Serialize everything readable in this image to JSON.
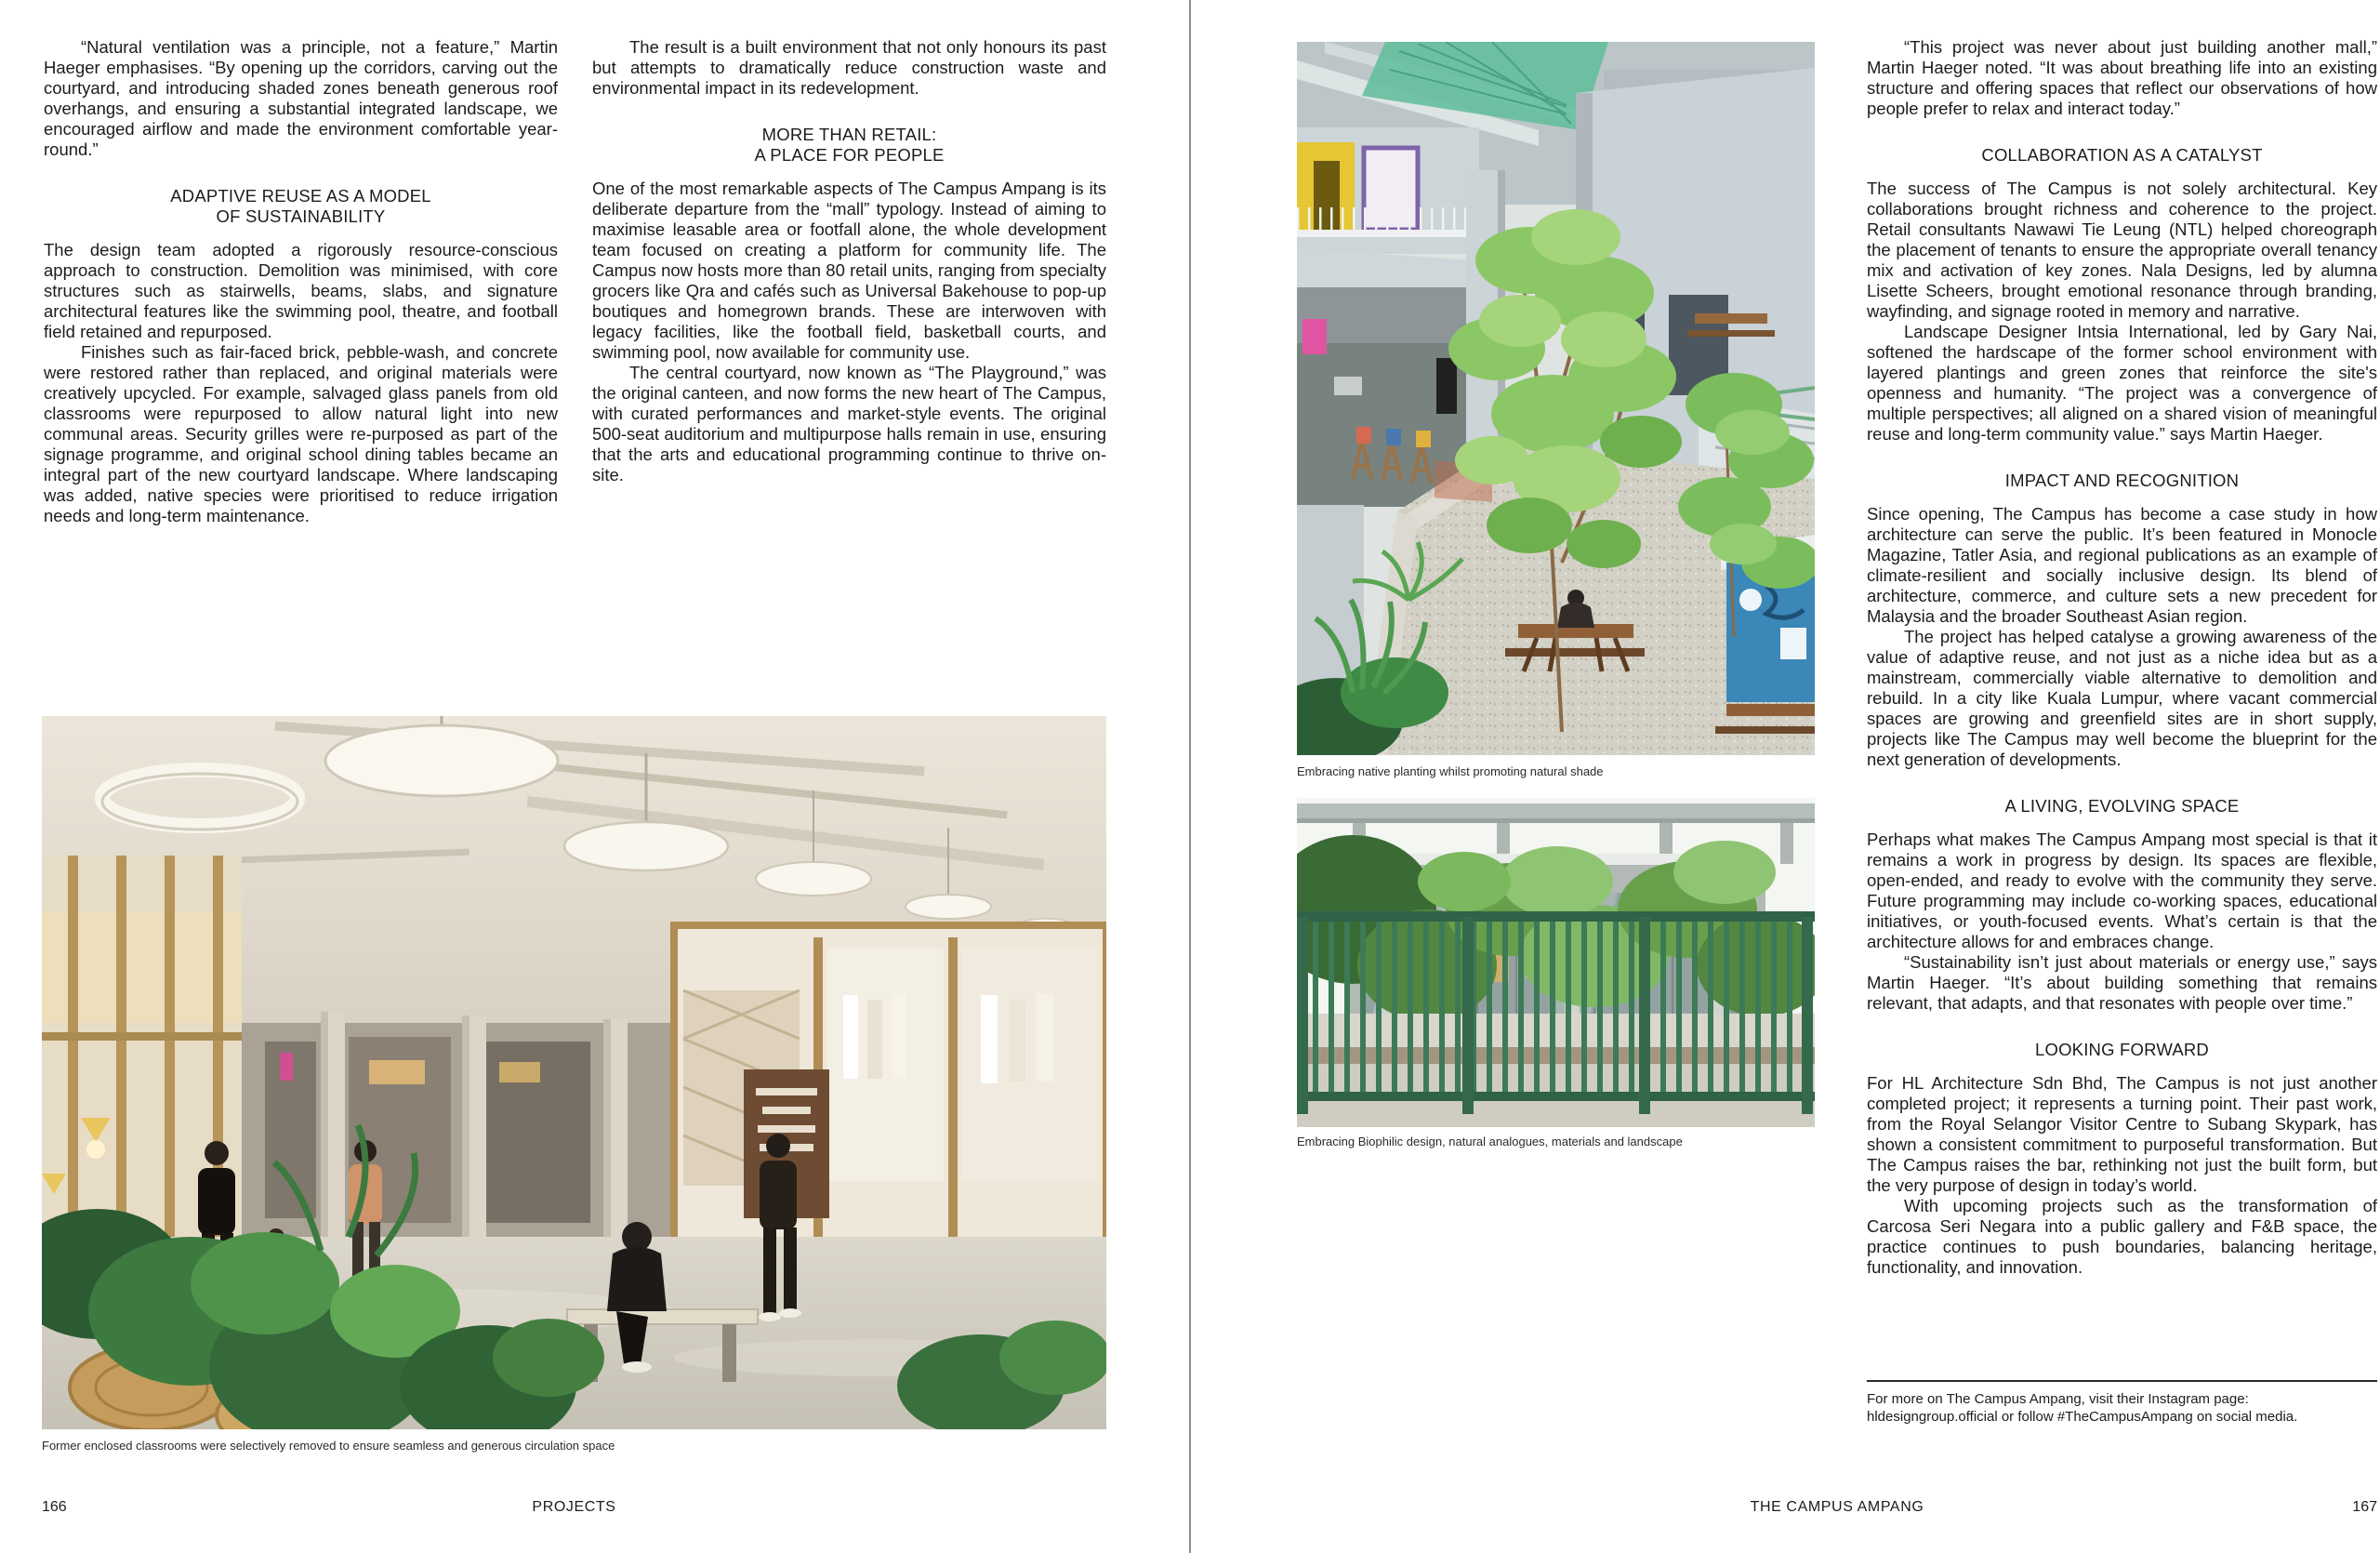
{
  "colors": {
    "paper": "#ffffff",
    "ink": "#1c1c1c",
    "caption": "#2a2a2a",
    "divider": "#8f8f8f",
    "note_rule": "#2a2a2a"
  },
  "page_left": {
    "page_number": "166",
    "running_foot": "PROJECTS",
    "col1": {
      "p1": "“Natural ventilation was a principle, not a feature,” Martin Haeger emphasises. “By opening up the corridors, carving out the courtyard, and introducing shaded zones beneath generous roof overhangs, and ensuring a substantial integrated landscape, we encouraged airflow and made the environment comfortable year-round.”",
      "heading": "ADAPTIVE REUSE AS A MODEL\nOF SUSTAINABILITY",
      "p2": "The design team adopted a rigorously resource-conscious approach to construction. Demolition was minimised, with core structures such as stairwells, beams, slabs, and signature architectural features like the swimming pool, theatre, and football field retained and repurposed.",
      "p3": "Finishes such as fair-faced brick, pebble-wash, and concrete were restored rather than replaced, and original materials were creatively upcycled. For example, salvaged glass panels from old classrooms were repurposed to allow natural light into new communal areas. Security grilles were re-purposed as part of the signage programme, and original school dining tables became an integral part of the new courtyard landscape. Where landscaping was added, native species were prioritised to reduce irrigation needs and long-term maintenance."
    },
    "col2": {
      "p1": "The result is a built environment that not only honours its past but attempts to dramatically reduce construction waste and environmental impact in its redevelopment.",
      "heading": "MORE THAN RETAIL:\nA PLACE FOR PEOPLE",
      "p2": "One of the most remarkable aspects of The Campus Ampang is its deliberate departure from the “mall” typology. Instead of aiming to maximise leasable area or footfall alone, the whole development team focused on creating a platform for community life. The Campus now hosts more than 80 retail units, ranging from specialty grocers like Qra and cafés such as Universal Bakehouse to pop-up boutiques and homegrown brands. These are interwoven with legacy facilities, like the football field, basketball courts, and swimming pool, now available for community use.",
      "p3": "The central courtyard, now known as “The Playground,” was the original canteen, and now forms the new heart of The Campus, with curated performances and market-style events. The original 500-seat auditorium and multipurpose halls remain in use, ensuring that the arts and educational programming continue to thrive on-site."
    },
    "photo_caption": "Former enclosed classrooms were selectively removed to ensure seamless and generous circulation space"
  },
  "page_right": {
    "page_number": "167",
    "running_foot": "THE CAMPUS AMPANG",
    "photo1_caption": "Embracing native planting whilst promoting natural shade",
    "photo2_caption": "Embracing Biophilic design, natural analogues, materials and landscape",
    "column": {
      "p1": "“This project was never about just building another mall,” Martin Haeger noted. “It was about breathing life into an existing structure and offering spaces that reflect our observations of how people prefer to relax and interact today.”",
      "h1": "COLLABORATION AS A CATALYST",
      "p2": "The success of The Campus is not solely architectural. Key collaborations brought richness and coherence to the project. Retail consultants Nawawi Tie Leung (NTL) helped choreograph the placement of tenants to ensure the appropriate overall tenancy mix and activation of key zones. Nala Designs, led by alumna Lisette Scheers, brought emotional resonance through branding, wayfinding, and signage rooted in memory and narrative.",
      "p3": "Landscape Designer Intsia International, led by Gary Nai, softened the hardscape of the former school environment with layered plantings and green zones that reinforce the site's openness and humanity. “The project was a convergence of multiple perspectives; all aligned on a shared vision of meaningful reuse and long-term community value.” says Martin Haeger.",
      "h2": "IMPACT AND RECOGNITION",
      "p4": "Since opening, The Campus has become a case study in how architecture can serve the public. It’s been featured in Monocle Magazine, Tatler Asia, and regional publications as an example of climate-resilient and socially inclusive design. Its blend of architecture, commerce, and culture sets a new precedent for Malaysia and the broader Southeast Asian region.",
      "p5": "The project has helped catalyse a growing awareness of the value of adaptive reuse, and not just as a niche idea but as a mainstream, commercially viable alternative to demolition and rebuild. In a city like Kuala Lumpur, where vacant commercial spaces are growing and greenfield sites are in short supply, projects like The Campus may well become the blueprint for the next generation of developments.",
      "h3": "A LIVING, EVOLVING SPACE",
      "p6": "Perhaps what makes The Campus Ampang most special is that it remains a work in progress by design. Its spaces are flexible, open-ended, and ready to evolve with the community they serve. Future programming may include co-working spaces, educational initiatives, or youth-focused events. What’s certain is that the architecture allows for and embraces change.",
      "p7": "“Sustainability isn’t just about materials or energy use,” says Martin Haeger. “It’s about building something that remains relevant, that adapts, and that resonates with people over time.”",
      "h4": "LOOKING FORWARD",
      "p8": "For HL Architecture Sdn Bhd, The Campus is not just another completed project; it represents a turning point. Their past work, from the Royal Selangor Visitor Centre to Subang Skypark, has shown a consistent commitment to purposeful transformation. But The Campus raises the bar, rethinking not just the built form, but the very purpose of design in today’s world.",
      "p9": "With upcoming projects such as the transformation of Carcosa Seri Negara into a public gallery and F&B space, the practice continues to push boundaries, balancing heritage, functionality, and innovation.",
      "note": "For more on The Campus Ampang, visit their Instagram page:\nhldesigngroup.official or follow #TheCampusAmpang on social media."
    }
  }
}
